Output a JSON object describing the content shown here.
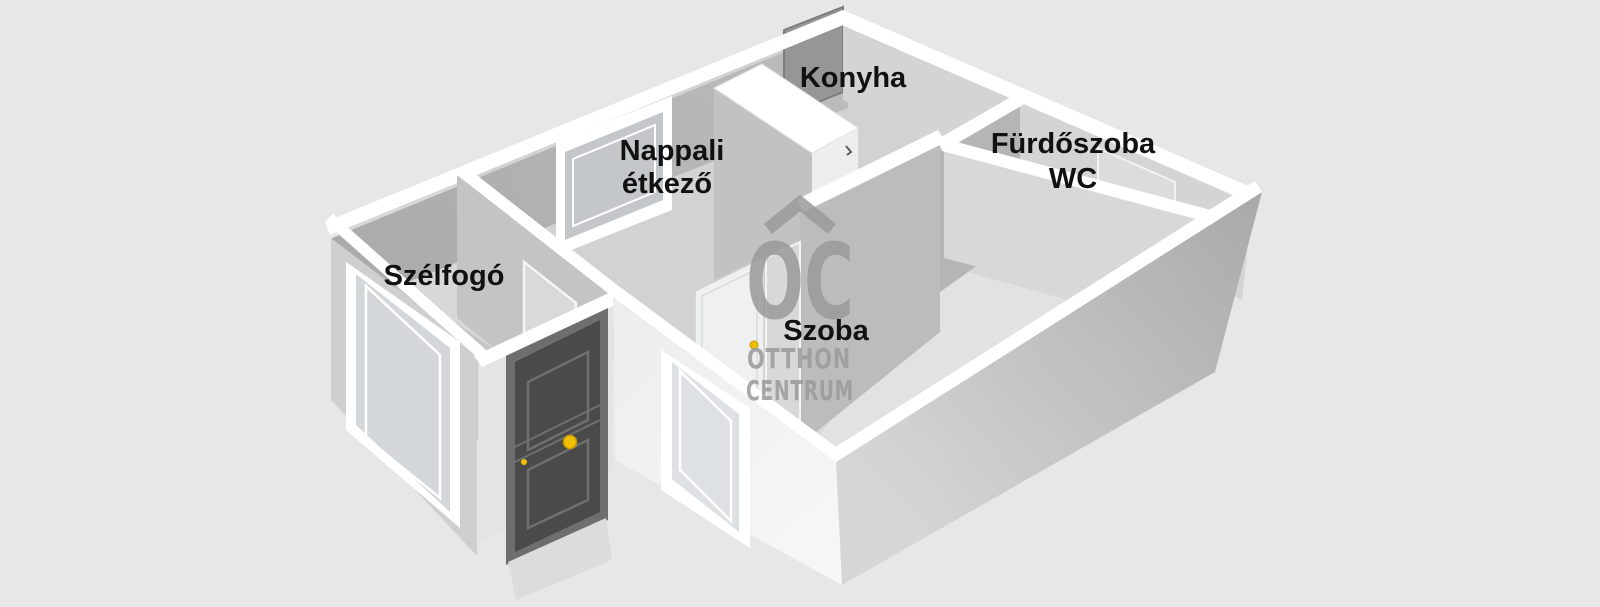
{
  "view": {
    "type": "3d-floorplan-render",
    "background_color": "#e7e7e7",
    "wall_top_color": "#ffffff",
    "label_color": "#111111"
  },
  "rooms": [
    {
      "id": "konyha",
      "label": "Konyha"
    },
    {
      "id": "nappali-etkezo",
      "label": "Nappali étkező",
      "line1": "Nappali",
      "line2": "étkező"
    },
    {
      "id": "furdoszoba-wc",
      "label": "Fürdőszoba WC",
      "line1": "Fürdőszoba",
      "line2": "WC"
    },
    {
      "id": "szelfogo",
      "label": "Szélfogó"
    },
    {
      "id": "szoba",
      "label": "Szoba"
    }
  ],
  "features": {
    "entrance_door_color": "#4a4a4a",
    "entrance_door_frame_color": "#6e6e6e",
    "door_hardware_color": "#f0c000",
    "open_interior_door_color": "#eef0f1",
    "window_glass_color": "#d5d8da"
  },
  "watermark": {
    "symbol": "OC",
    "roof_icon": "roof-chevron",
    "line1": "OTTHON",
    "line2": "CENTRUM",
    "color": "#9a9a9a"
  }
}
